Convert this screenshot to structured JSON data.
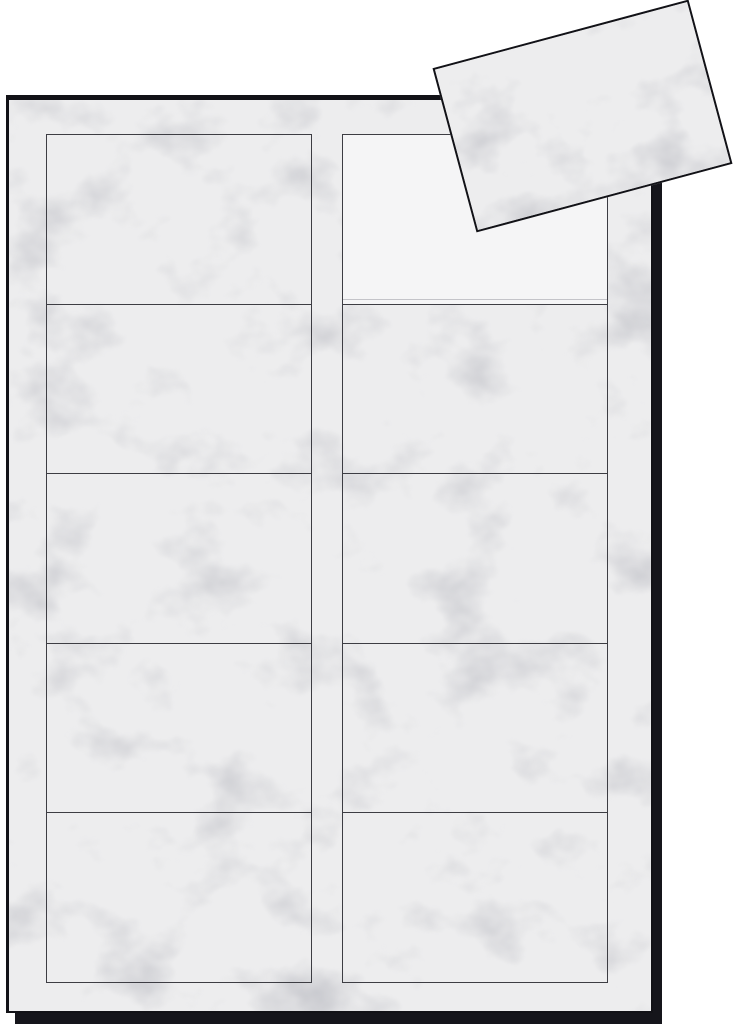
{
  "scene": {
    "type": "product-photo",
    "subject": "blank-marble-business-card-sheet-with-one-detached-card",
    "background_color": "#ffffff"
  },
  "sheet": {
    "grid": {
      "columns": 2,
      "rows": 5,
      "total_slots": 10,
      "filled_slots": 9
    },
    "empty_slot": {
      "column": 2,
      "row": 1
    },
    "texture": "gray-marble"
  },
  "detached_card": {
    "present": true,
    "rotation_deg": -15,
    "texture": "gray-marble",
    "location": "overlapping-top-right-corner-of-sheet"
  },
  "colors": {
    "bg": "#ffffff",
    "marble_base": "#ededee",
    "marble_vein": "#b9bac1",
    "empty_slot": "#f5f5f6",
    "grid_line": "#3d3d43",
    "slot_inner_line": "#c4c4c9",
    "sheet_edge": "#121217",
    "shadow": "#15151b"
  }
}
